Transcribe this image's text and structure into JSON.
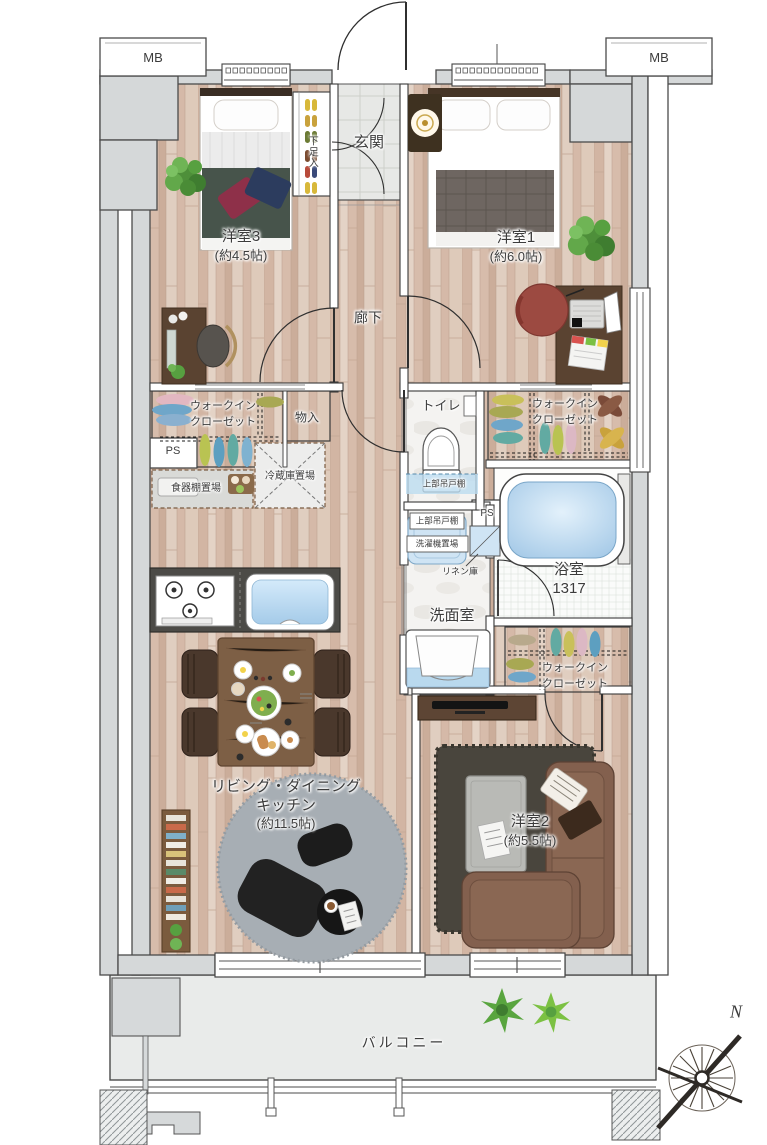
{
  "labels": {
    "mb_left": "MB",
    "mb_right": "MB",
    "entrance": "玄関",
    "shoe_cabinet": "下足入",
    "bedroom3": {
      "name": "洋室3",
      "size": "(約4.5帖)"
    },
    "bedroom1": {
      "name": "洋室1",
      "size": "(約6.0帖)"
    },
    "bedroom2": {
      "name": "洋室2",
      "size": "(約5.5帖)"
    },
    "corridor": "廊下",
    "toilet": "トイレ",
    "wic_left": {
      "line1": "ウォークイン",
      "line2": "クローゼット"
    },
    "wic_right_upper": {
      "line1": "ウォークイン",
      "line2": "クローゼット"
    },
    "wic_right_lower": {
      "line1": "ウォークイン",
      "line2": "クローゼット"
    },
    "storage": "物入",
    "ps_left": "PS",
    "ps_right": "PS",
    "fridge_space": "冷蔵庫置場",
    "cupboard_space": "食器棚置場",
    "upper_cabinet_toilet": "上部吊戸棚",
    "upper_cabinet_washer": "上部吊戸棚",
    "washer_space": "洗濯機置場",
    "linen": "リネン庫",
    "bathroom": {
      "name": "浴室",
      "size": "1317"
    },
    "washroom": "洗面室",
    "ldk": {
      "line1": "リビング・ダイニング",
      "line2": "キッチン",
      "size": "(約11.5帖)"
    },
    "balcony": "バルコニー",
    "compass_north": "N"
  },
  "colors": {
    "wall_gray": "#d5d8d9",
    "wood_floor": "#dcc6b6",
    "tile_gray": "#e7e8e6",
    "water_blue": "#b9d9ee",
    "cabinet_blue": "#cfe4f4",
    "blanket_green": "#47544b",
    "blanket_gray": "#6e6661",
    "sofa_brown": "#83604e",
    "rug_gray": "#a7aeb4",
    "rug_dark": "#49453d",
    "counter_dark": "#4c4b47",
    "line_dark": "#3a3a3a"
  }
}
